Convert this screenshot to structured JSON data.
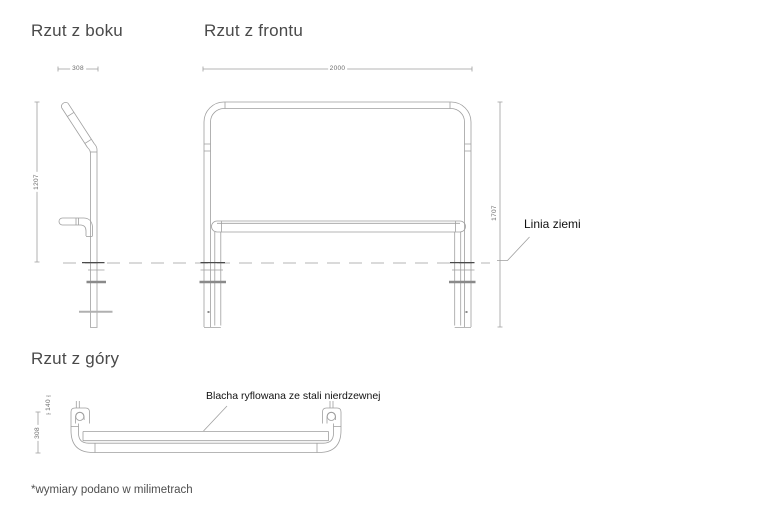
{
  "document": {
    "type": "technical-drawing",
    "unit_note": "*wymiary podano w milimetrach"
  },
  "views": {
    "side": {
      "title": "Rzut z boku",
      "width_mm": "308",
      "height_mm": "1207"
    },
    "front": {
      "title": "Rzut z frontu",
      "width_mm": "2000",
      "height_mm": "1707",
      "ground_label": "Linia ziemi"
    },
    "top": {
      "title": "Rzut z góry",
      "offset_mm": "140",
      "depth_mm": "308",
      "plate_label": "Blacha ryflowana ze stali nierdzewnej"
    }
  },
  "colors": {
    "background": "#ffffff",
    "drawing_line": "#9f9f9f",
    "dashed_ground_line": "#b5b5b5",
    "dark_accent_line": "#4a4a4a",
    "title_text": "#4a4a4a",
    "dimension_text": "#6b6b6b",
    "label_text": "#111111"
  }
}
